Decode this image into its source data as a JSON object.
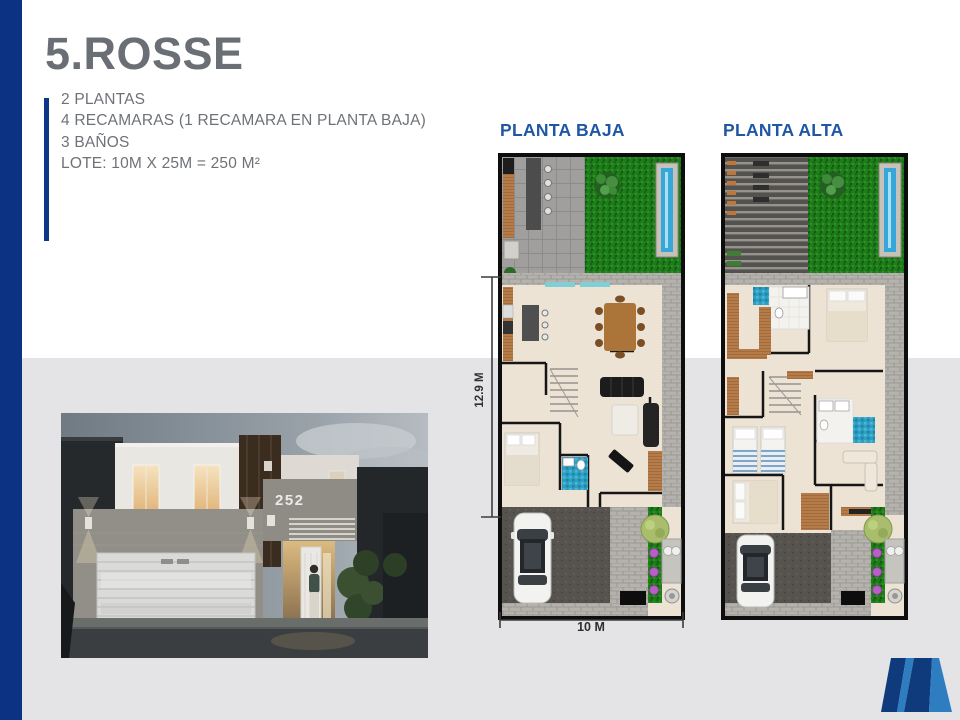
{
  "slide": {
    "title": "5.ROSSE",
    "specs": [
      "2 PLANTAS",
      "4 RECAMARAS (1 RECAMARA EN PLANTA BAJA)",
      "3 BAÑOS",
      "LOTE: 10M X 25M = 250 M²"
    ]
  },
  "floorplans": {
    "left": {
      "label": "PLANTA BAJA"
    },
    "right": {
      "label": "PLANTA ALTA"
    },
    "dimensions": {
      "depth": "12.9 M",
      "width": "10 M"
    }
  },
  "photo": {
    "house_number": "252"
  },
  "branding": {
    "logo_icon": "m-brand-logo"
  },
  "colors": {
    "accent_navy": "#0d3588",
    "title_gray": "#6a6f75",
    "label_blue": "#1f57a5",
    "background_gray": "#e4e4e6",
    "logo_dark": "#0f3a7c",
    "logo_light": "#2f7dc1"
  }
}
